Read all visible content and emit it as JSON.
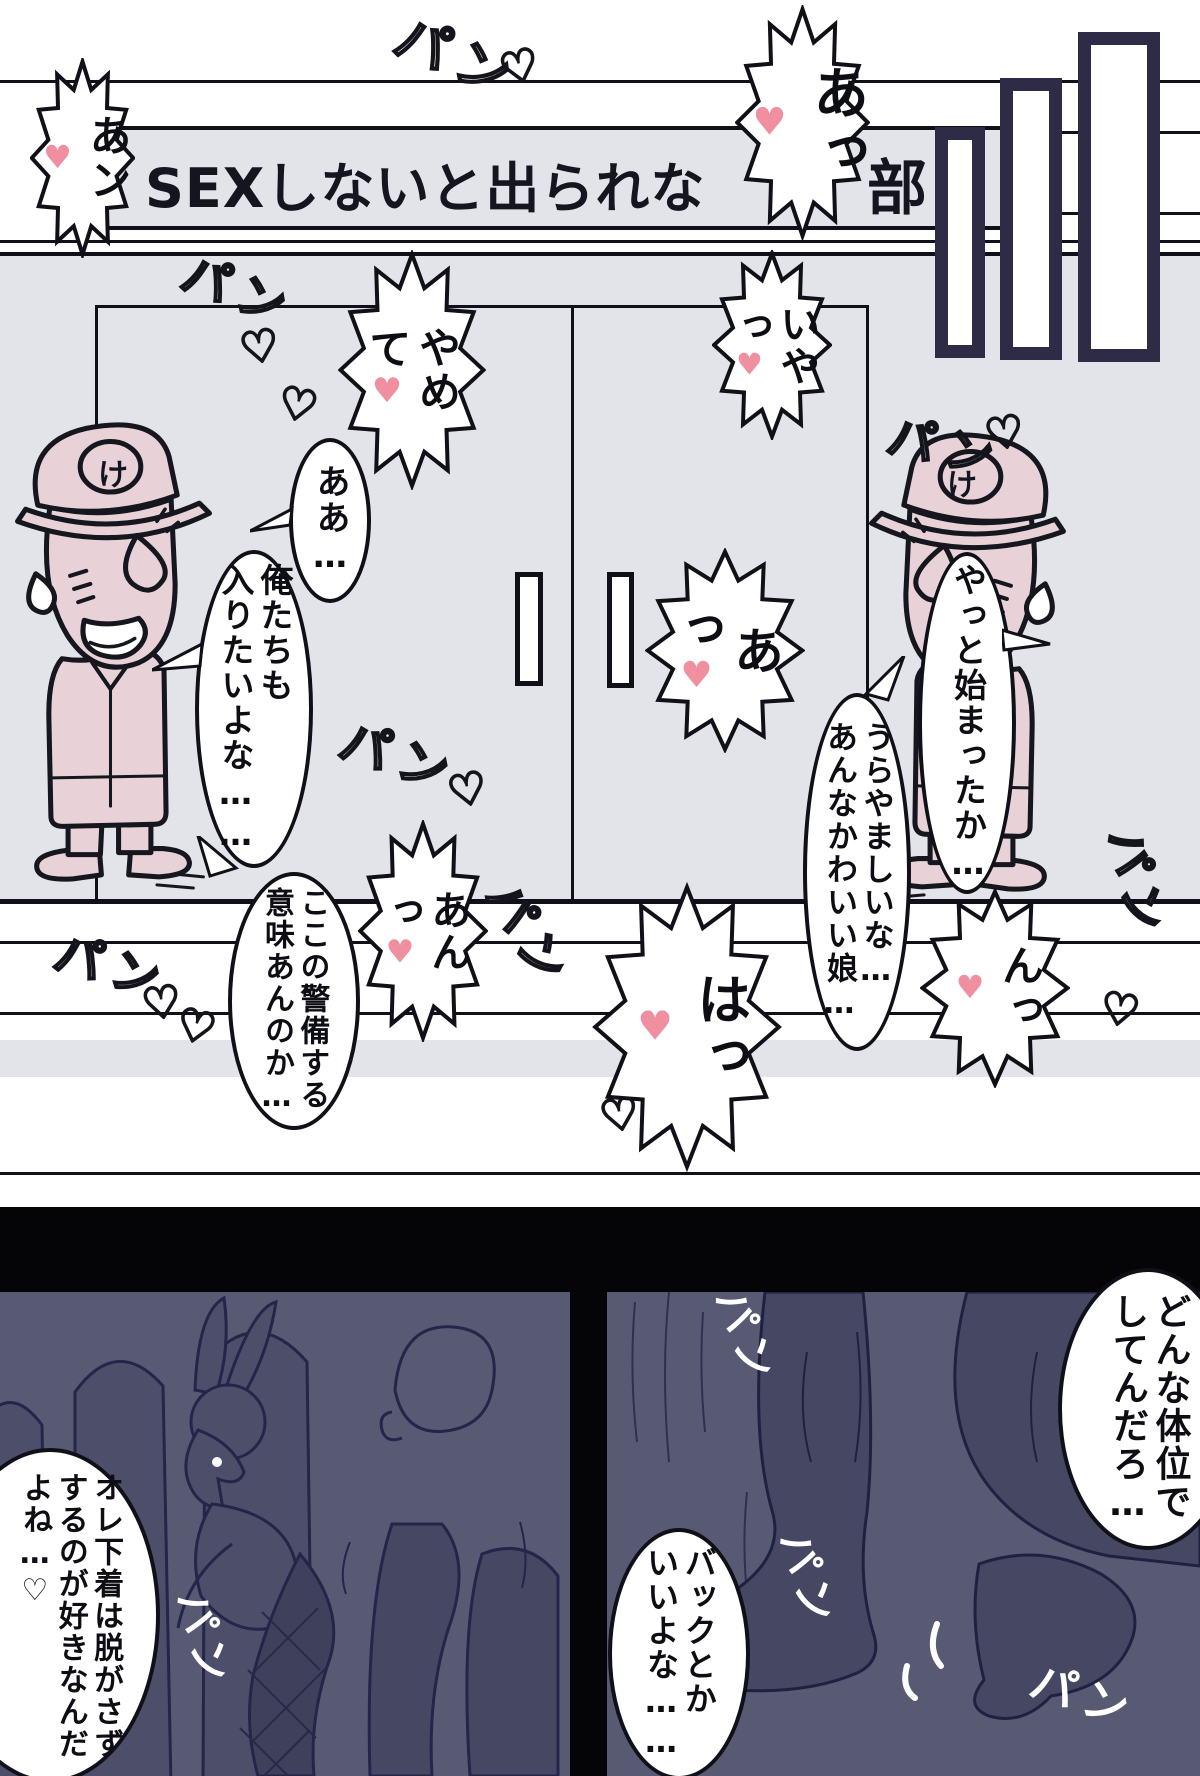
{
  "sign": {
    "visible_left": "SEXしないと出られな",
    "visible_right": "部"
  },
  "characters": {
    "cap_badge": "け"
  },
  "dialogue": {
    "aa": "ああ…",
    "oretachi": "俺たちも\n入りたいよな……",
    "keibi": "ここの警備する\n意味あんのか…",
    "yatto": "やっと始まったか…",
    "urayamashii": "うらやましいな…\nあんなかわいい娘…",
    "donna": "どんな体位で\nしてんだろ…",
    "back": "バックとか\nいいよな……",
    "shitagi": "オレ下着は脱がさず\nするのが好きなんだ\nよね…♡"
  },
  "exclaim": {
    "an1": "あン",
    "a1": "あっ",
    "iya": "いやっ",
    "yamete": "やめて",
    "a2": "あっ",
    "ann": "あんっ",
    "ha": "はっ",
    "n": "んっ"
  },
  "sfx": {
    "pan": "パン",
    "heart_outline": "♡",
    "heart_solid": "♥"
  },
  "colors": {
    "wall_gray": "#e2e4e9",
    "bar_navy": "#2d2b46",
    "panel_purple": "#585a74",
    "silhouette": "#4d4f6a",
    "accent_pink": "#ef8fa0"
  }
}
